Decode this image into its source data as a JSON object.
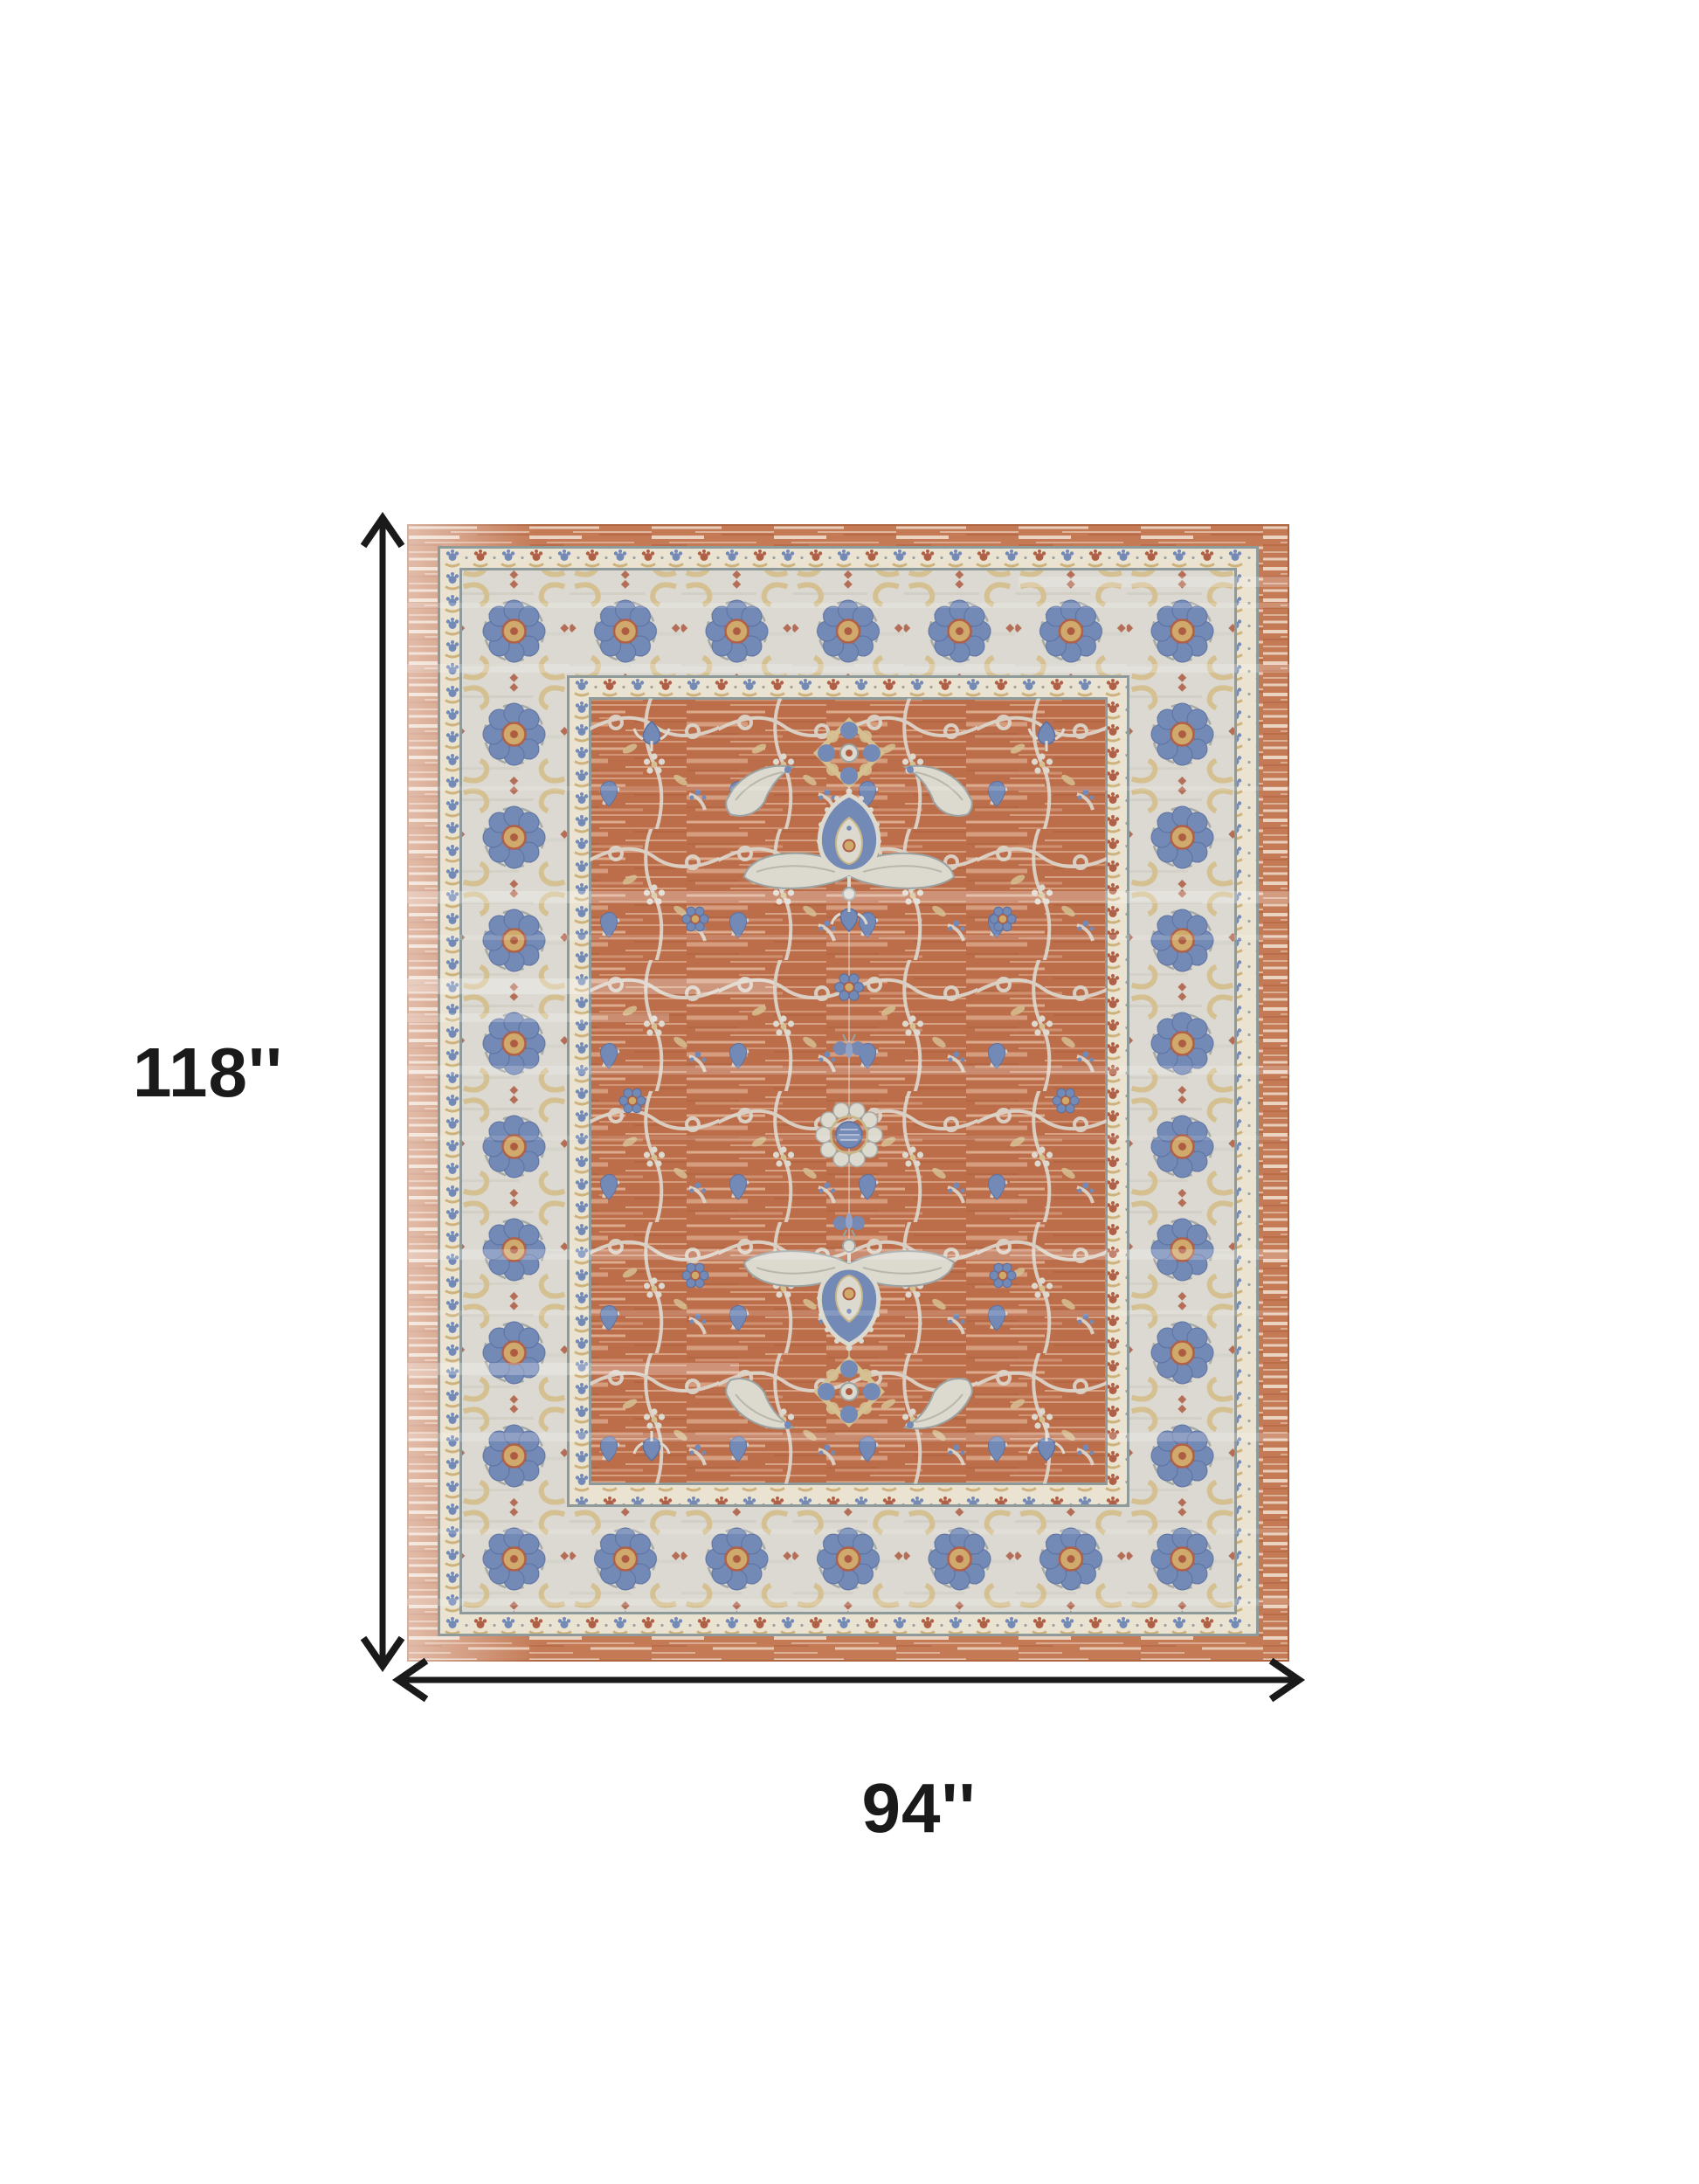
{
  "page": {
    "background_color": "#ffffff"
  },
  "diagram": {
    "type": "product-dimension-diagram",
    "subject": "area rug shown from above with measurement arrows",
    "arrow_color": "#1a1a1a",
    "vertical_dimension": {
      "label": "118''",
      "icon": "double-arrow-vertical"
    },
    "horizontal_dimension": {
      "label": "94''",
      "icon": "double-arrow-horizontal"
    }
  },
  "rug": {
    "style": "distressed traditional oriental rug, terracotta field with ivory floral borders",
    "colors": {
      "terracotta": "#bc6e4b",
      "terracotta_light": "#eac3a8",
      "outer_band": "#c47a55",
      "ivory_border": "#dbd9d1",
      "cream_guard": "#eae3d1",
      "blue_accent": "#7389b6",
      "tan_accent": "#d5c092",
      "rust_accent": "#ad5c41",
      "outline_gray": "#8f9a9a",
      "edge": "#b0643e"
    }
  }
}
